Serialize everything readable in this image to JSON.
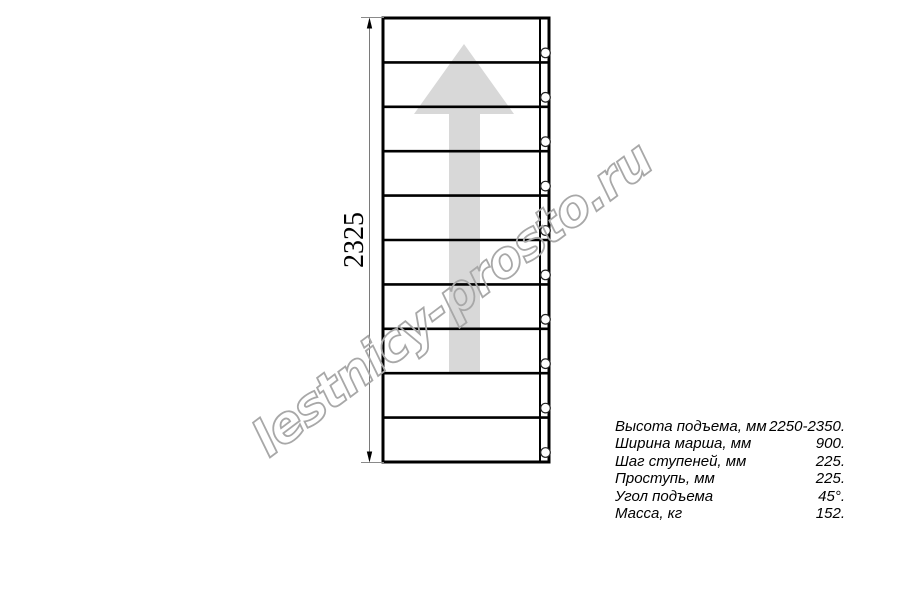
{
  "watermark": {
    "text": "lestnicy-prosto.ru"
  },
  "drawing": {
    "dimension_label": "2325",
    "tread_count": 10,
    "bolt_count": 10
  },
  "colors": {
    "arrow": "#d8d8d8",
    "line": "#000000",
    "dimension_line": "#7a7a7a",
    "watermark": "#a8a8a8"
  },
  "specs": {
    "rows": [
      {
        "label": "Высота подъема, мм",
        "value": "2250-2350."
      },
      {
        "label": "Ширина марша, мм",
        "value": "900."
      },
      {
        "label": "Шаг ступеней, мм",
        "value": "225."
      },
      {
        "label": "Проступь, мм",
        "value": "225."
      },
      {
        "label": "Угол подъема",
        "value": "45°."
      },
      {
        "label": "Масса, кг",
        "value": "152."
      }
    ]
  }
}
